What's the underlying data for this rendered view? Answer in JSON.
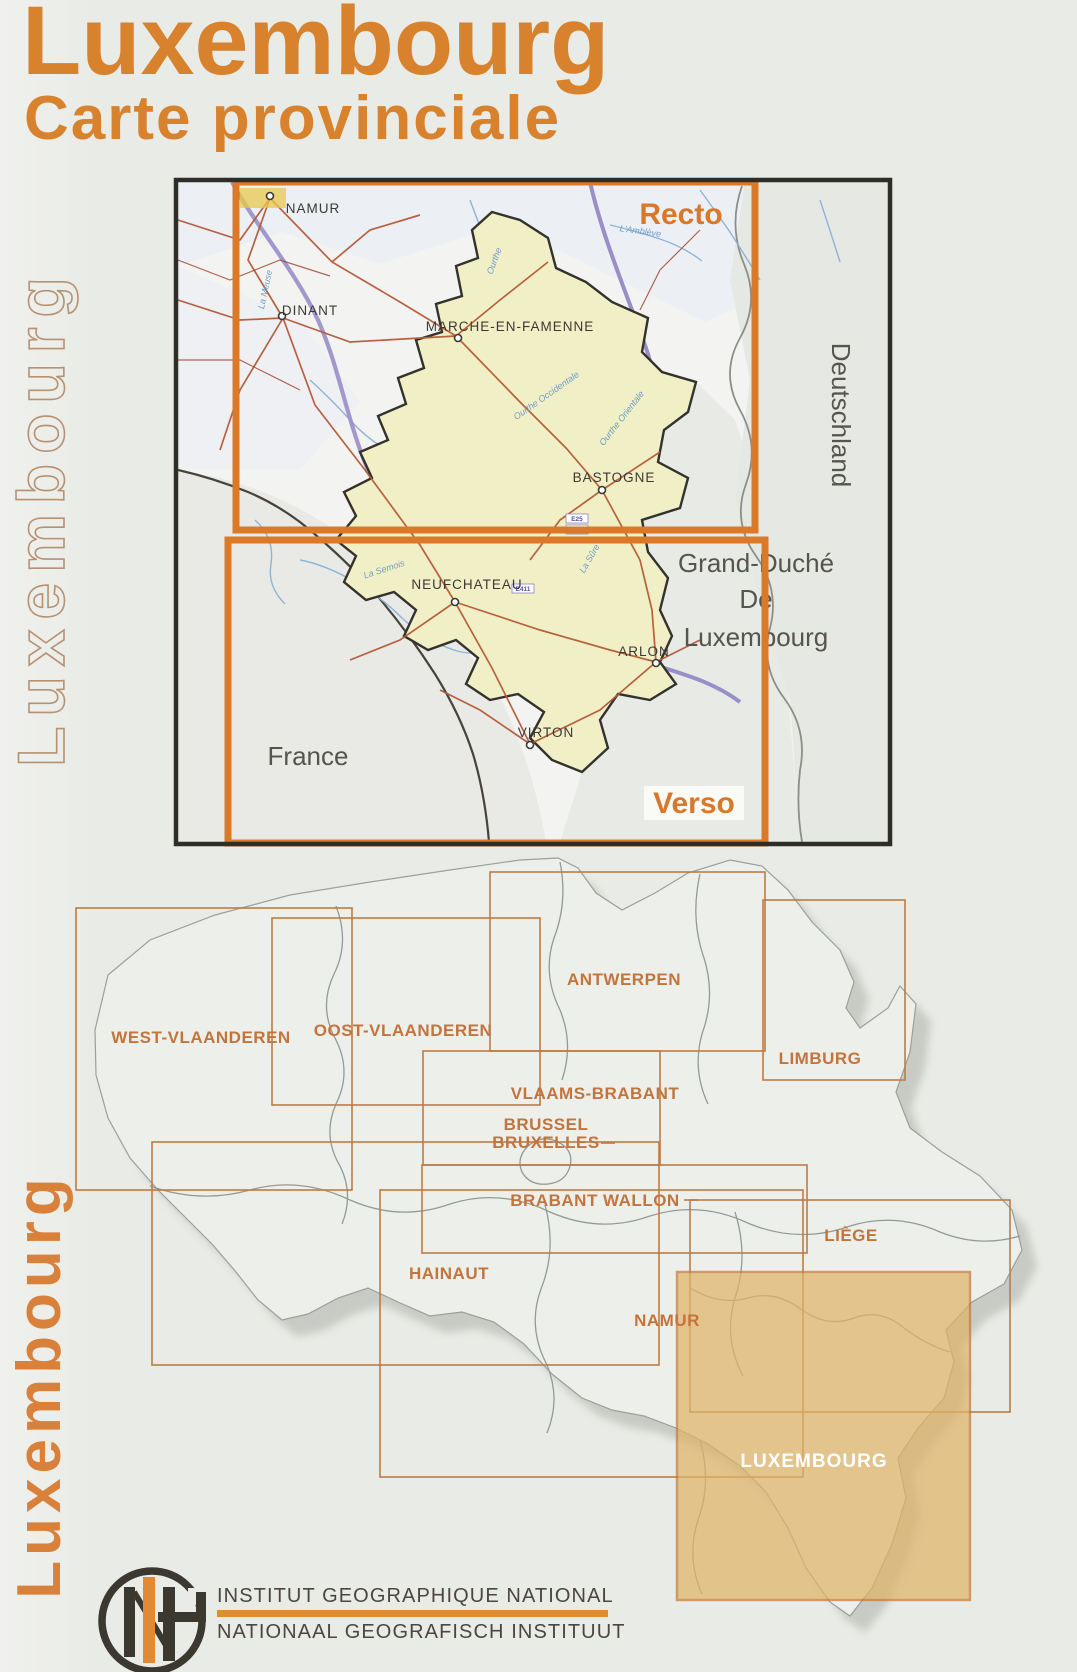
{
  "title": {
    "line1": "Luxembourg",
    "line2": "Carte provinciale"
  },
  "side_text": {
    "top": "Luxembourg",
    "bottom": "Luxembourg"
  },
  "top_map": {
    "recto_label": "Recto",
    "verso_label": "Verso",
    "cities": [
      "NAMUR",
      "DINANT",
      "MARCHE-EN-FAMENNE",
      "BASTOGNE",
      "NEUFCHATEAU",
      "ARLON",
      "VIRTON"
    ],
    "regions": {
      "germany": "Deutschland",
      "france": "France",
      "grand_duchy_line1": "Grand-Duché",
      "grand_duchy_line2": "De",
      "grand_duchy_line3": "Luxembourg"
    },
    "river_labels": [
      "La Meuse",
      "Ourthe",
      "L'Amblève",
      "Ourthe Occidentale",
      "Ourthe Orientale",
      "La Semois",
      "La Sûre"
    ],
    "road_shields": [
      "E25",
      "E411",
      "E411"
    ]
  },
  "bottom_map": {
    "province_labels": [
      "WEST-VLAANDEREN",
      "OOST-VLAANDEREN",
      "ANTWERPEN",
      "LIMBURG",
      "VLAAMS-BRABANT",
      "BRUSSEL",
      "BRUXELLES",
      "BRABANT WALLON",
      "HAINAUT",
      "NAMUR",
      "LIÈGE"
    ],
    "highlight_label": "LUXEMBOURG"
  },
  "footer": {
    "line1": "INSTITUT GEOGRAPHIQUE NATIONAL",
    "line2": "NATIONAAL GEOGRAFISCH INSTITUUT",
    "logo": "NGI monogram"
  },
  "colors": {
    "accent_orange": "#d8822e",
    "frame_orange": "#da7a28",
    "label_orange": "#c3743c",
    "highlight_tan": "#e0b468",
    "province_yellow": "#f1efc5"
  }
}
